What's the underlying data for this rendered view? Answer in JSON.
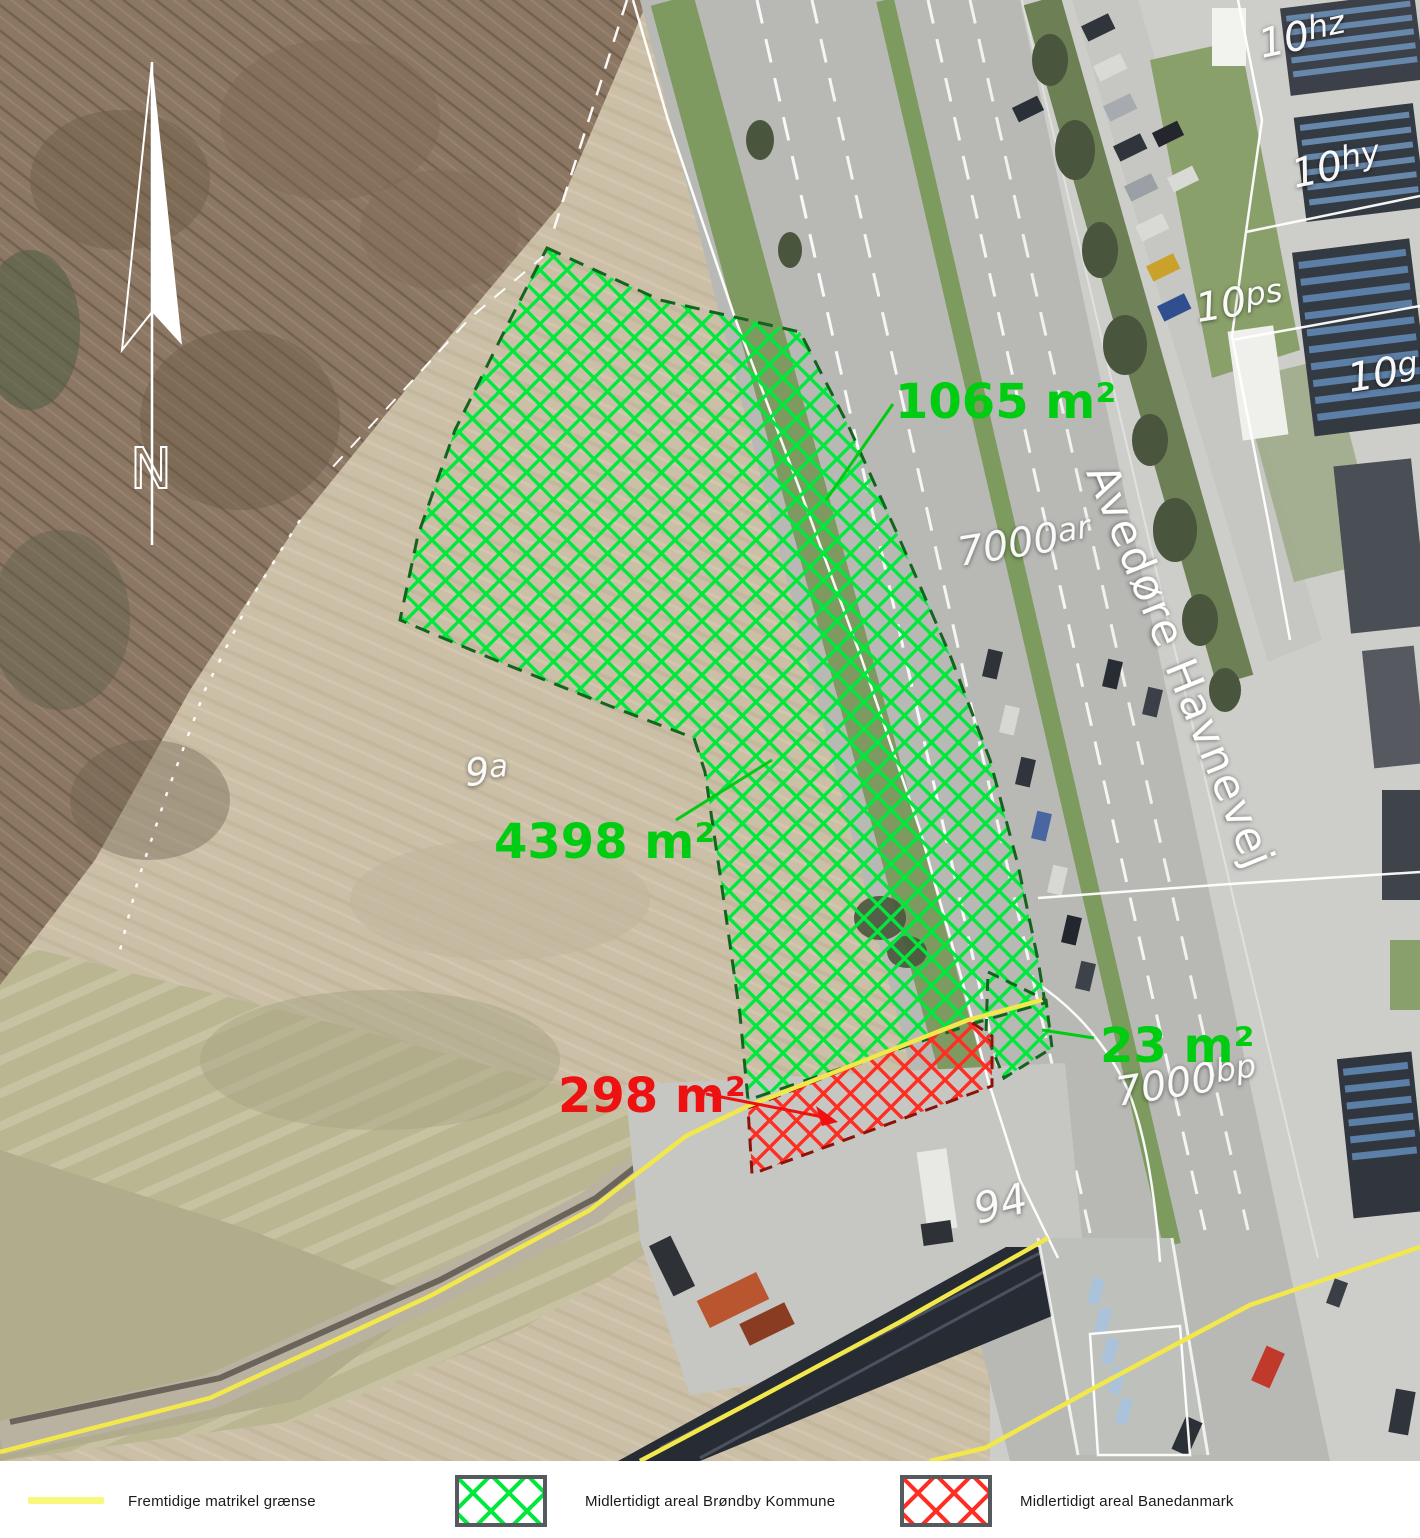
{
  "figure": {
    "type": "aerial-cadastral-map"
  },
  "north_label": "N",
  "street_label": "Avedøre Havnevej",
  "area_labels": [
    {
      "id": "north-strip",
      "text": "1065 m²",
      "color": "#00cc11"
    },
    {
      "id": "main-area",
      "text": "4398 m²",
      "color": "#00cc11"
    },
    {
      "id": "banedanmark-strip",
      "text": "298 m²",
      "color": "#ee1111"
    },
    {
      "id": "east-sliver",
      "text": "23 m²",
      "color": "#00cc11"
    }
  ],
  "parcel_labels": [
    {
      "base": "10",
      "sup": "hz"
    },
    {
      "base": "10",
      "sup": "hy"
    },
    {
      "base": "10",
      "sup": "ps"
    },
    {
      "base": "10",
      "sup": "gb"
    },
    {
      "base": "7000",
      "sup": "ar"
    },
    {
      "base": "7000",
      "sup": "bp"
    },
    {
      "base": "9",
      "sup": "a"
    },
    {
      "base": "94",
      "sup": ""
    }
  ],
  "legend": {
    "items": [
      {
        "swatch": "yellow-line",
        "label": "Fremtidige matrikel grænse"
      },
      {
        "swatch": "green-hatch",
        "label": "Midlertidigt areal Brøndby Kommune"
      },
      {
        "swatch": "red-hatch",
        "label": "Midlertidigt areal Banedanmark"
      }
    ]
  },
  "colors": {
    "hatch_green": "#00e83c",
    "hatch_red": "#ff2d22",
    "border_green": "#14641f",
    "border_red": "#8c130c",
    "boundary_yellow": "#f2e84c",
    "label_green": "#00cc11",
    "label_red": "#ee1111"
  }
}
